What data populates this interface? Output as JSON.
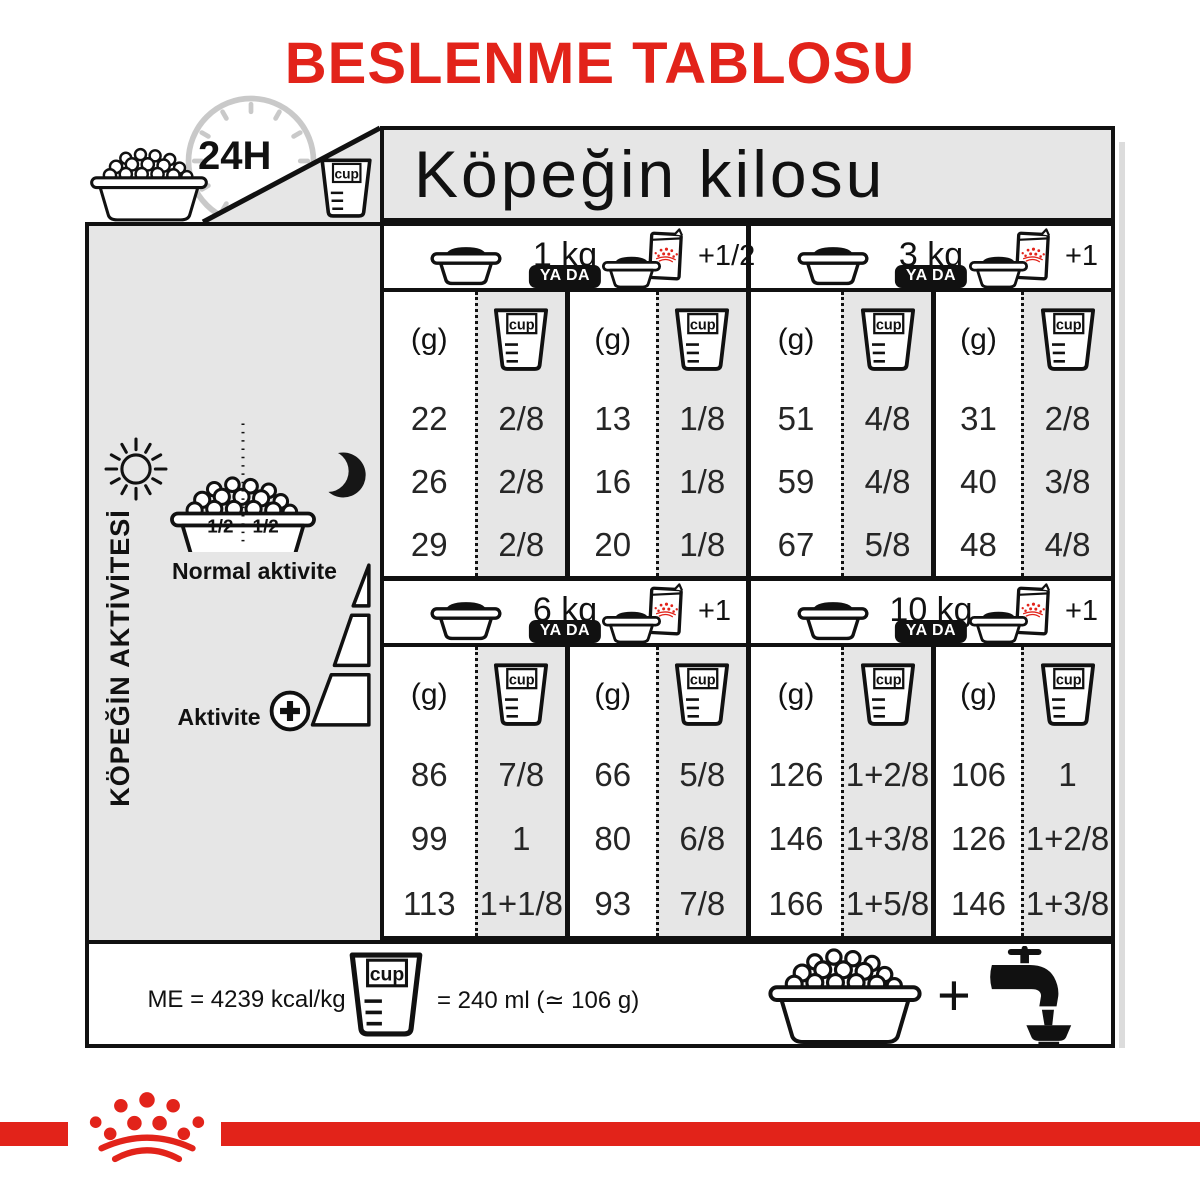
{
  "title": "BESLENME TABLOSU",
  "colors": {
    "red": "#e2231a",
    "panel_gray": "#e6e6e6",
    "line_black": "#111111"
  },
  "corner": {
    "hours": "24H"
  },
  "header": {
    "weight_title": "Köpeğin kilosu"
  },
  "sidebar": {
    "vertical_label": "KÖPEĞİN AKTİVİTESİ",
    "half_left": "1/2",
    "half_right": "1/2",
    "normal_label": "Normal aktivite",
    "active_label": "Aktivite"
  },
  "table": {
    "or_label": "YA DA",
    "g_header": "(g)",
    "cup": "cup",
    "sections": [
      {
        "weight": "1 kg",
        "extra": "+1/2",
        "dry_g": [
          "22",
          "26",
          "29"
        ],
        "dry_cup": [
          "2/8",
          "2/8",
          "2/8"
        ],
        "mix_g": [
          "13",
          "16",
          "20"
        ],
        "mix_cup": [
          "1/8",
          "1/8",
          "1/8"
        ]
      },
      {
        "weight": "3 kg",
        "extra": "+1",
        "dry_g": [
          "51",
          "59",
          "67"
        ],
        "dry_cup": [
          "4/8",
          "4/8",
          "5/8"
        ],
        "mix_g": [
          "31",
          "40",
          "48"
        ],
        "mix_cup": [
          "2/8",
          "3/8",
          "4/8"
        ]
      },
      {
        "weight": "6 kg",
        "extra": "+1",
        "dry_g": [
          "86",
          "99",
          "113"
        ],
        "dry_cup": [
          "7/8",
          "1",
          "1+1/8"
        ],
        "mix_g": [
          "66",
          "80",
          "93"
        ],
        "mix_cup": [
          "5/8",
          "6/8",
          "7/8"
        ]
      },
      {
        "weight": "10 kg",
        "extra": "+1",
        "dry_g": [
          "126",
          "146",
          "166"
        ],
        "dry_cup": [
          "1+2/8",
          "1+3/8",
          "1+5/8"
        ],
        "mix_g": [
          "106",
          "126",
          "146"
        ],
        "mix_cup": [
          "1",
          "1+2/8",
          "1+3/8"
        ]
      }
    ]
  },
  "footer": {
    "me": "ME = 4239 kcal/kg",
    "equiv": "= 240 ml (≃ 106 g)",
    "plus": "+"
  },
  "chart_data": {
    "type": "table",
    "title": "BESLENME TABLOSU",
    "column_group_header": "Köpeğin kilosu",
    "row_group_header": "KÖPEĞİN AKTİVİTESİ",
    "rows_note": "3 rows per weight group, activity increasing from Normal aktivite to Aktivite (+)",
    "weight_groups": [
      {
        "weight_kg": 1,
        "dry_only": {
          "g": [
            22,
            26,
            29
          ],
          "cup": [
            "2/8",
            "2/8",
            "2/8"
          ]
        },
        "with_pouch": {
          "pouches": "+1/2",
          "g": [
            13,
            16,
            20
          ],
          "cup": [
            "1/8",
            "1/8",
            "1/8"
          ]
        }
      },
      {
        "weight_kg": 3,
        "dry_only": {
          "g": [
            51,
            59,
            67
          ],
          "cup": [
            "4/8",
            "4/8",
            "5/8"
          ]
        },
        "with_pouch": {
          "pouches": "+1",
          "g": [
            31,
            40,
            48
          ],
          "cup": [
            "2/8",
            "3/8",
            "4/8"
          ]
        }
      },
      {
        "weight_kg": 6,
        "dry_only": {
          "g": [
            86,
            99,
            113
          ],
          "cup": [
            "7/8",
            "1",
            "1+1/8"
          ]
        },
        "with_pouch": {
          "pouches": "+1",
          "g": [
            66,
            80,
            93
          ],
          "cup": [
            "5/8",
            "6/8",
            "7/8"
          ]
        }
      },
      {
        "weight_kg": 10,
        "dry_only": {
          "g": [
            126,
            146,
            166
          ],
          "cup": [
            "1+2/8",
            "1+3/8",
            "1+5/8"
          ]
        },
        "with_pouch": {
          "pouches": "+1",
          "g": [
            106,
            126,
            146
          ],
          "cup": [
            "1",
            "1+2/8",
            "1+3/8"
          ]
        }
      }
    ],
    "footnotes": [
      "ME = 4239 kcal/kg",
      "cup = 240 ml (≃ 106 g)",
      "24H",
      "YA DA = or"
    ]
  }
}
